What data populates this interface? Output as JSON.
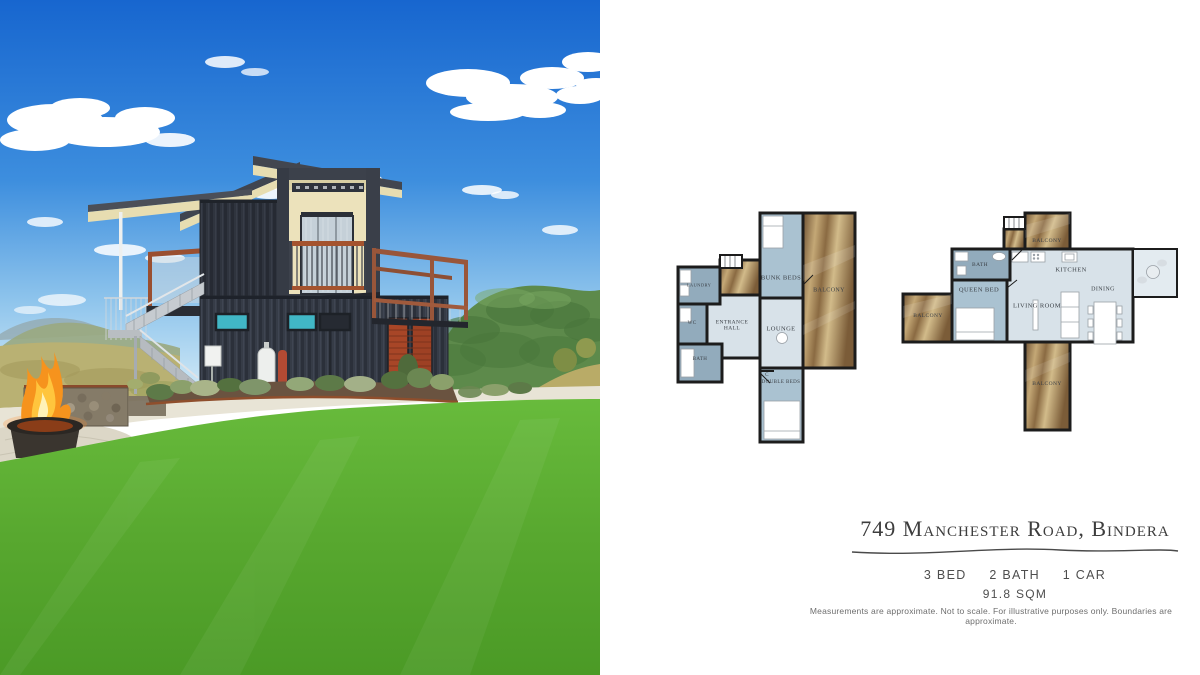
{
  "listing": {
    "address": "749 Manchester Road, Bindera",
    "specs": {
      "beds": "3 BED",
      "baths": "2 BATH",
      "cars": "1 CAR"
    },
    "area": "91.8 SQM",
    "disclaimer": "Measurements are approximate. Not to scale. For illustrative purposes only. Boundaries are approximate."
  },
  "floor_plans": {
    "plan1": {
      "rooms": {
        "laundry": "LAUNDRY",
        "wc": "WC",
        "bath": "BATH",
        "entrance_hall": "ENTRANCE HALL",
        "lounge": "LOUNGE",
        "bunk_beds": "BUNK BEDS",
        "double_beds": "DOUBLE BEDS",
        "balcony": "BALCONY",
        "cupboard": "C"
      }
    },
    "plan2": {
      "rooms": {
        "balcony_top": "BALCONY",
        "bath": "BATH",
        "queen_bed": "QUEEN BED",
        "living_room": "LIVING ROOM",
        "kitchen": "KITCHEN",
        "dining": "DINING",
        "balcony_left": "BALCONY",
        "balcony_bottom": "BALCONY"
      }
    }
  },
  "palette": {
    "sky_top": "#1a6fd4",
    "sky_horizon": "#d6ecf7",
    "lawn_green": "#57a82f",
    "container_charcoal": "#343a45",
    "roof_underside_cream": "#e7ddb1",
    "railing_rust": "#a4532e",
    "window_teal": "#41b7c6",
    "plan_wall": "#1c1c1c",
    "plan_room_dark": "#92abbc",
    "plan_room_light": "#d8e2e9",
    "plan_wood": "#a9854f"
  }
}
